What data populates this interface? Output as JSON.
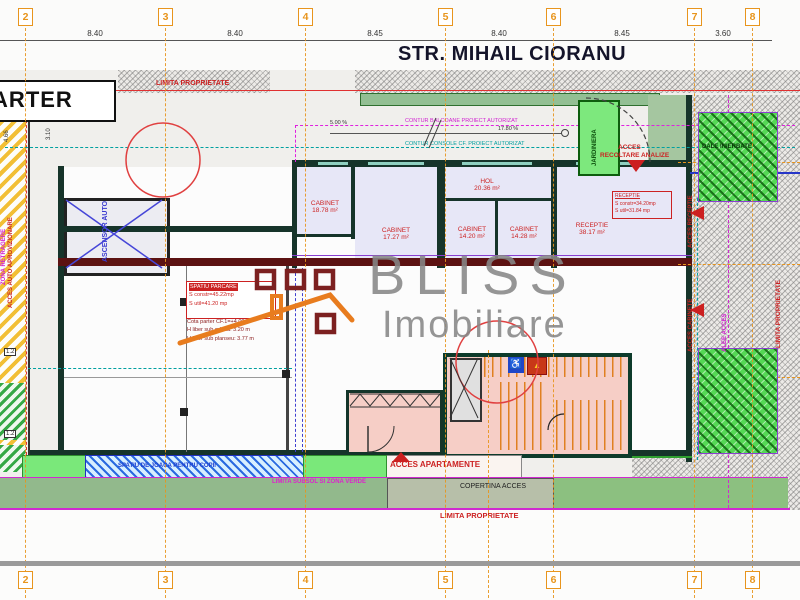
{
  "street": {
    "title": "STR. MIHAIL CIORANU"
  },
  "floor": {
    "label": "PARTER"
  },
  "grid": {
    "bubbles": [
      "2",
      "3",
      "4",
      "5",
      "6",
      "7",
      "8"
    ],
    "dims": [
      "8.40",
      "8.40",
      "8.45",
      "8.40",
      "8.45",
      "3.60"
    ]
  },
  "limits": {
    "top": "LIMITA PROPRIETATE",
    "bottom": "LIMITA PROPRIETATE",
    "right": "LIMITA PROPRIETATE"
  },
  "rooms": [
    {
      "name": "CABINET",
      "area": "18.78 m²"
    },
    {
      "name": "CABINET",
      "area": "17.27 m²"
    },
    {
      "name": "HOL",
      "area": "20.36 m²"
    },
    {
      "name": "CABINET",
      "area": "14.20 m²"
    },
    {
      "name": "CABINET",
      "area": "14.28 m²"
    },
    {
      "name": "RECEPTIE",
      "area": "38.17 m²"
    }
  ],
  "lift": {
    "label": "ASCENSOR AUTO"
  },
  "notes": {
    "note1": {
      "header": "SPATIU PARCARE",
      "l2": "S constr=45.22mp",
      "l3": "S util=41.20 mp",
      "l4": "Cota parter CF.1=+4.00",
      "l5": "H liber sub grinda: 3.20 m",
      "l6": "H liber sub planseu: 3.77 m"
    },
    "note2": {
      "header": "RECEPTIE",
      "l2": "S constr=34.20mp",
      "l3": "S util=31.84 mp"
    }
  },
  "ann": {
    "contur_balcoane": "CONTUR BALCOANE PROIECT AUTORIZAT",
    "contur_console": "CONTUR CONSOLE CF. PROIECT AUTORIZAT",
    "slope_left": "5.00 %",
    "slope_right": "17.80 %",
    "acces_recoltare_1": "ACCES",
    "acces_recoltare_2": "RECOLTARE ANALIZE",
    "acces_receptie": "ACCES RECEPTIE",
    "acces_cabinete": "ACCES CABINETE",
    "acces_apartamente": "ACCES APARTAMENTE",
    "copertina": "COPERTINA ACCES",
    "dale": "DALE INIERBATE",
    "jardiniera": "JARDINIERA",
    "playground": "SPATIU DE JOACA PENTRU COPII",
    "green_limit": "LIMITA SUBSOL SI ZONA VERDE",
    "acces_auto": "ACCES AUTO APROVIZIONARE",
    "zona_left": "ZONA RETRAGERE",
    "alee": "ALEE ACCES"
  },
  "dims_misc": {
    "v466": "4.66",
    "v310": "3.10",
    "b12": "1.2"
  },
  "watermark": {
    "brand": "BLISS",
    "sub": "Imobiliare"
  },
  "icons": {
    "wheelchair": "♿",
    "warning": "▲"
  },
  "colors": {
    "grid_orange": "#e8951d",
    "limit_red": "#e03030",
    "magenta": "#d02ad0",
    "teal": "#00a0a0",
    "wall_green": "#16342a",
    "maroon": "#5c1212"
  }
}
